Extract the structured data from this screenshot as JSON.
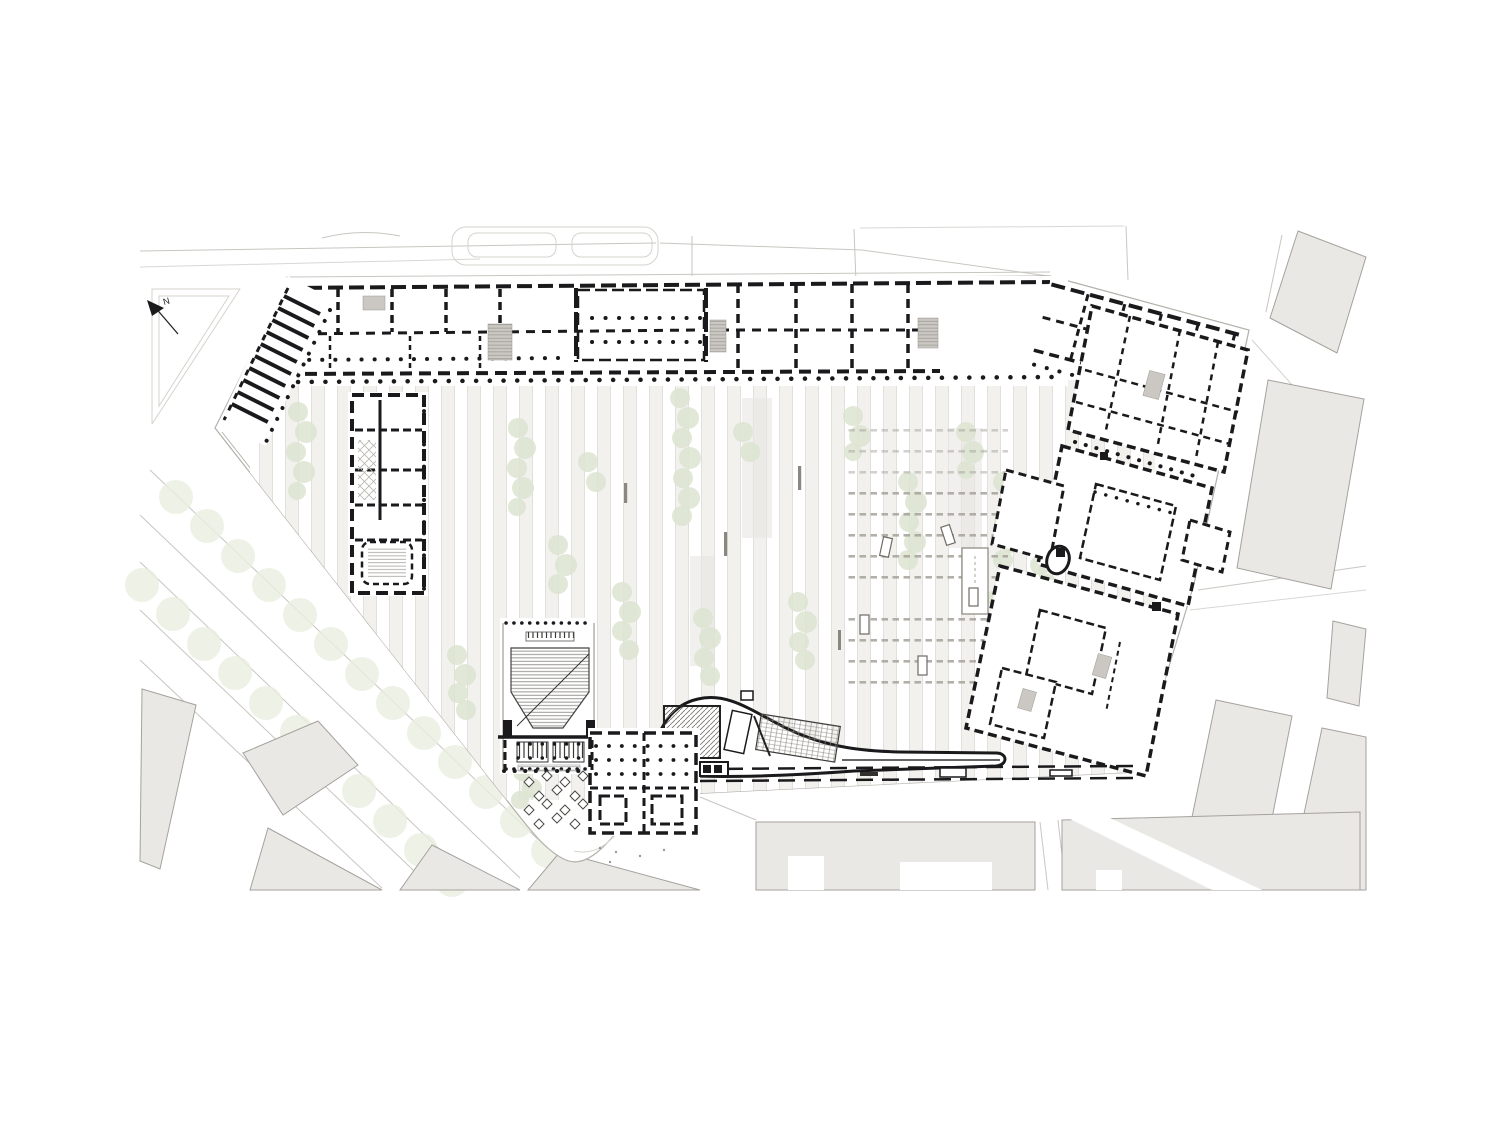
{
  "north_arrow": {
    "label": "N"
  },
  "colors": {
    "page-bg": "#ffffff",
    "plan-black": "#1a191c",
    "site-outline": "#b3b0aa",
    "street-line": "#c9c6c1",
    "faint-outline": "#d6d3ce",
    "context-fill": "#eae8e5",
    "context-outline": "#a5a29d",
    "stair-gray": "#cbc8c3",
    "hatch-gray": "#908d87",
    "tree-green": "#dce4d0",
    "tree-faint": "#eaeee0",
    "stripe-fill": "#f2f1ee",
    "stripe-line": "#dfddd8",
    "stall-gray": "#a6a29b",
    "bench-gray": "#8a8781",
    "furniture-outline": "#6f6b64"
  }
}
